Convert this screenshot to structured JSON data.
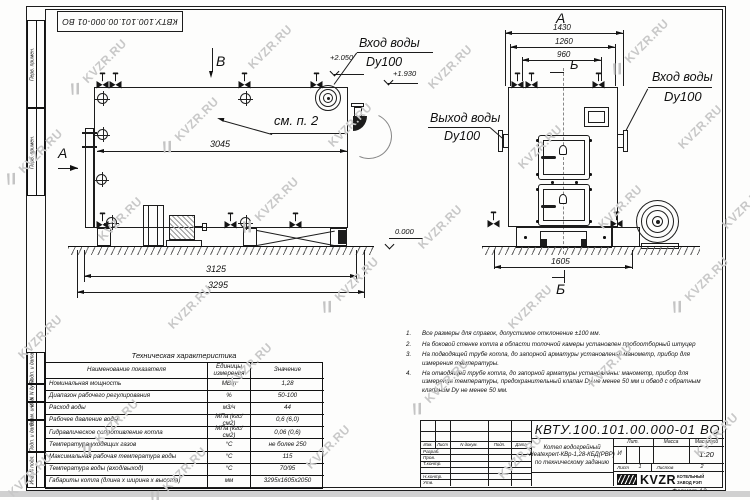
{
  "doc": {
    "number": "КВТУ.100.101.00.000-01 ВО",
    "format_label": "Формат",
    "format_value": "А3"
  },
  "watermark": {
    "text": "KVZR.RU"
  },
  "sidebar": [
    "Перв. примен.",
    "Перв. примен.",
    "Подп. и дата",
    "Инв. N дубл.",
    "Взам. инв. N",
    "Подп. и дата",
    "Инв. N подл."
  ],
  "left_view": {
    "view_label": "В",
    "section_label": "А",
    "callout": "см. п. 2",
    "dim_top": "3045",
    "dim_skid": "3125",
    "dim_overall": "3295",
    "elev_inlet": "+2.050",
    "elev_outlet": "+1.930",
    "elev_ground": "0.000",
    "inlet_line1": "Вход воды",
    "inlet_line2": "Dу100"
  },
  "front_view": {
    "view_label": "А",
    "section_label_top": "Б",
    "section_label_bottom": "Б",
    "dim_1": "1430",
    "dim_2": "1260",
    "dim_3": "960",
    "dim_bottom": "1605",
    "outlet_line1": "Выход воды",
    "outlet_line2": "Dу100",
    "inlet_line1": "Вход воды",
    "inlet_line2": "Dу100"
  },
  "notes": [
    "Все размеры для справок, допустимое отклонение ±100 мм.",
    "На боковой стенке котла в области топочной камеры установлен пробоотборный штуцер",
    "На подводящей трубе котла, до запорной арматуры установлены: манометр, прибор для измерения температуры.",
    "На отводящей трубе котла, до запорной арматуры установлены: манометр, прибор для измерения температуры, предохранительный клапан Dу не менее 50 мм и обвод с обратным клапаном Dу не менее 50 мм."
  ],
  "table": {
    "title": "Техническая характеристика",
    "headers": [
      "Наименование показателя",
      "Единицы измерения",
      "Значение"
    ],
    "rows": [
      [
        "Номинальная мощность",
        "МВт",
        "1,28"
      ],
      [
        "Диапазон рабочего регулирования",
        "%",
        "50-100"
      ],
      [
        "Расход воды",
        "м3/ч",
        "44"
      ],
      [
        "Рабочее давление воды",
        "МПа (кгс/см2)",
        "0,6 (6,0)"
      ],
      [
        "Гидравлическое сопротивление котла",
        "МПа (кгс/см2)",
        "0,06 (0,6)"
      ],
      [
        "Температура уходящих газов",
        "°С",
        "не более 250"
      ],
      [
        "Максимальная рабочая температура воды",
        "°С",
        "115"
      ],
      [
        "Температура воды (вход/выход)",
        "°С",
        "70/95"
      ],
      [
        "Габариты котла (длина х ширина х высота)",
        "мм",
        "3295х1605х2050"
      ]
    ]
  },
  "titleblock": {
    "header_cols": [
      "Изм.",
      "Лист",
      "N докум.",
      "Подп.",
      "Дата"
    ],
    "left_rows": [
      "Разраб.",
      "Пров.",
      "Т.контр.",
      "",
      "Н.контр.",
      "Утв."
    ],
    "number": "КВТУ.100.101.00.000-01 ВО",
    "name_lines": [
      "Котел водогрейный",
      "Heatexpert-КВр-1,28-КБД(РВР)",
      "по техническому заданию"
    ],
    "lit_label": "Лит.",
    "lit_value": "И",
    "mass_label": "Масса",
    "scale_label": "Масштаб",
    "scale_value": "1:20",
    "sheet_label": "Лист",
    "sheet_value": "1",
    "sheets_label": "Листов",
    "sheets_value": "2",
    "company_logo": "KVZR",
    "company_line1": "КОТЕЛЬНЫЙ",
    "company_line2": "ЗАВОД РЭП"
  }
}
